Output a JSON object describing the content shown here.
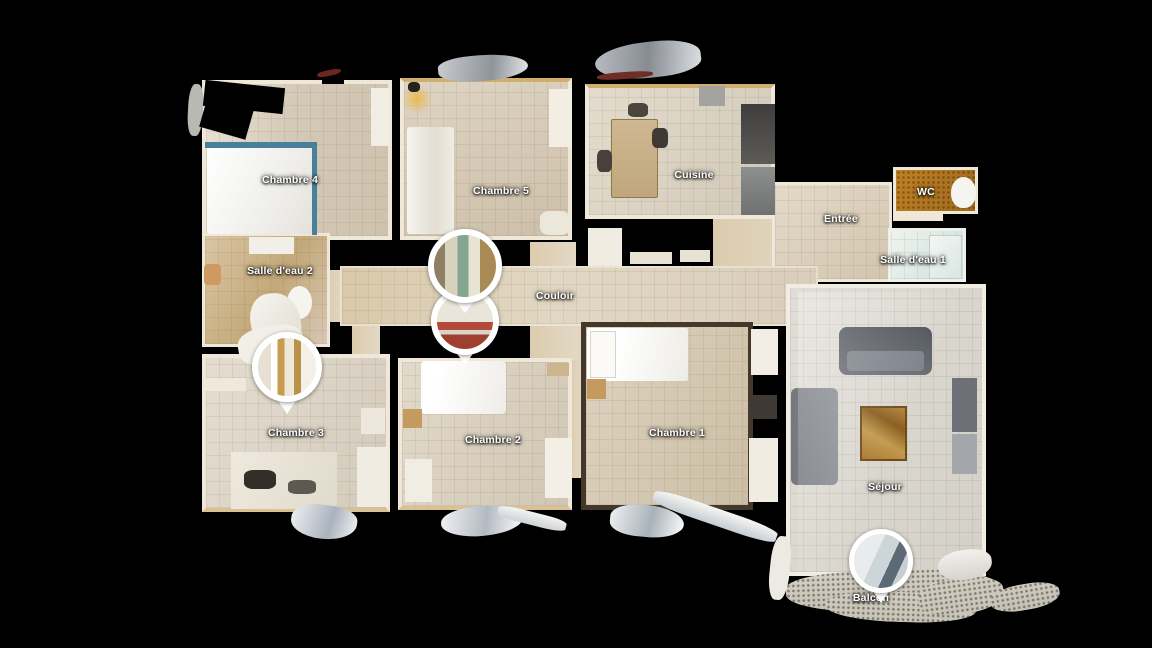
{
  "view": {
    "type": "floorplan-3d-top-view",
    "background": "#000000",
    "label_color": "#ffffff",
    "wall_color": "#efe8d9",
    "marker_ring_color": "#ffffff"
  },
  "floorplan": {
    "rooms": [
      {
        "id": "chambre-4",
        "label": "Chambre 4",
        "x": 202,
        "y": 80,
        "w": 190,
        "h": 160,
        "label_cx": 290,
        "label_cy": 180,
        "floor": "linear-gradient(100deg,#e9e1d3 0%,#d4c9b7 45%,#cfc2ad 100%)",
        "wall": "4px solid #efe8d9"
      },
      {
        "id": "chambre-5",
        "label": "Chambre 5",
        "x": 400,
        "y": 78,
        "w": 172,
        "h": 162,
        "label_cx": 501,
        "label_cy": 191,
        "floor": "linear-gradient(160deg,#ded4c3 0%,#cdbfa9 100%)",
        "wall": "4px solid #efe8d9",
        "wallTop": "#cfae6e"
      },
      {
        "id": "cuisine",
        "label": "Cuisine",
        "x": 585,
        "y": 84,
        "w": 190,
        "h": 135,
        "label_cx": 694,
        "label_cy": 175,
        "floor": "linear-gradient(120deg,#e3dccd 0%,#d1c8b7 100%)",
        "wall": "4px solid #efe8d9",
        "wallTop": "#cfae6e"
      },
      {
        "id": "wc",
        "label": "WC",
        "x": 893,
        "y": 167,
        "w": 85,
        "h": 47,
        "label_cx": 926,
        "label_cy": 192,
        "grid": false,
        "floor": "radial-gradient(rgba(70,40,5,.45) 1px, transparent 1.6px) 0 0/5px 5px, linear-gradient(120deg,#c08124,#9c6a1d)",
        "wall": "3px solid #efe8d9"
      },
      {
        "id": "entree",
        "label": "Entrée",
        "x": 772,
        "y": 182,
        "w": 120,
        "h": 100,
        "label_cx": 841,
        "label_cy": 219,
        "floor": "linear-gradient(140deg,#e4dac9 0%,#d2c5ae 100%)",
        "wall": "3px solid #efe8d9"
      },
      {
        "id": "salle-eau-1",
        "label": "Salle d'eau 1",
        "x": 888,
        "y": 228,
        "w": 78,
        "h": 54,
        "label_cx": 913,
        "label_cy": 260,
        "floor": "linear-gradient(120deg,#eff3f0 0%,#cfe0da 100%)",
        "wall": "3px solid #eef0ea"
      },
      {
        "id": "salle-eau-2",
        "label": "Salle d'eau 2",
        "x": 202,
        "y": 233,
        "w": 128,
        "h": 114,
        "label_cx": 280,
        "label_cy": 271,
        "floor": "linear-gradient(120deg,#dac6a5 0%,#c3a878 55%,#d8c7b4 100%)",
        "wall": "3px solid #efe8d9"
      },
      {
        "id": "couloir",
        "label": "Couloir",
        "x": 340,
        "y": 266,
        "w": 478,
        "h": 60,
        "label_cx": 555,
        "label_cy": 296,
        "floor": "linear-gradient(90deg,#d9c9aa 0%,#e1d7c3 45%,#dacebb 100%)",
        "wall": "2px solid rgba(240,233,219,.7)"
      },
      {
        "id": "chambre-3",
        "label": "Chambre 3",
        "x": 202,
        "y": 354,
        "w": 188,
        "h": 158,
        "label_cx": 296,
        "label_cy": 433,
        "floor": "linear-gradient(115deg,#e4ddd0 0%,#d3cabb 100%)",
        "wall": "4px solid #efe8d9",
        "wallBottom": "#d9c193"
      },
      {
        "id": "chambre-2",
        "label": "Chambre 2",
        "x": 398,
        "y": 358,
        "w": 174,
        "h": 152,
        "label_cx": 493,
        "label_cy": 440,
        "floor": "linear-gradient(115deg,#e1d9ca 0%,#d0c6b3 100%)",
        "wall": "4px solid #efe8d9",
        "wallBottom": "#d9c193"
      },
      {
        "id": "chambre-1",
        "label": "Chambre 1",
        "x": 581,
        "y": 322,
        "w": 172,
        "h": 188,
        "label_cx": 677,
        "label_cy": 433,
        "floor": "linear-gradient(115deg,#ded3c0 0%,#ccbea5 100%)",
        "wall": "5px solid #43382a"
      },
      {
        "id": "sejour",
        "label": "Séjour",
        "x": 786,
        "y": 284,
        "w": 200,
        "h": 292,
        "label_cx": 885,
        "label_cy": 487,
        "floor": "linear-gradient(115deg,#e1ded7 0%,#d3d0c7 100%)",
        "wall": "4px solid #f2ede2"
      },
      {
        "id": "balcon",
        "label": "Balcon",
        "x": 786,
        "y": 570,
        "w": 212,
        "h": 42,
        "label_cx": 871,
        "label_cy": 598,
        "grid": false,
        "rotate": -2,
        "radius": "35% 45% 40% 50%",
        "floor": "radial-gradient(rgba(45,40,30,.5) 1px, transparent 1.6px) 0 0/5px 5px, linear-gradient(#d4cfc3,#c6c1b5)"
      }
    ],
    "passages": [
      {
        "id": "door-couloir-chambre-5",
        "x": 530,
        "y": 242,
        "w": 46,
        "h": 26
      },
      {
        "id": "strip-chambre-2-1",
        "x": 570,
        "y": 326,
        "w": 12,
        "h": 152
      },
      {
        "id": "door-couloir-south",
        "x": 530,
        "y": 326,
        "w": 47,
        "h": 34
      },
      {
        "id": "passage-entree",
        "x": 713,
        "y": 212,
        "w": 100,
        "h": 58
      },
      {
        "id": "door-couloir-chambre-3",
        "x": 352,
        "y": 326,
        "w": 28,
        "h": 30
      },
      {
        "id": "door-salle-eau-2",
        "x": 326,
        "y": 270,
        "w": 18,
        "h": 52
      }
    ],
    "passage_floor": "linear-gradient(90deg,#dcccae,#e2d8c4)",
    "props": [
      {
        "name": "bed-chambre-4",
        "x": 207,
        "y": 146,
        "w": 107,
        "h": 88,
        "fill": "linear-gradient(115deg,#ffffff,#edece8 70%,#e4e1da)",
        "radius": "3px"
      },
      {
        "name": "bed-frame-top-chambre-4",
        "x": 205,
        "y": 142,
        "w": 112,
        "h": 6,
        "fill": "#47809a"
      },
      {
        "name": "bed-frame-right-chambre-4",
        "x": 312,
        "y": 142,
        "w": 5,
        "h": 93,
        "fill": "#47809a"
      },
      {
        "name": "shelf-chambre-4",
        "x": 371,
        "y": 88,
        "w": 19,
        "h": 58,
        "fill": "#f1ede3"
      },
      {
        "name": "wardrobe-chambre-5",
        "x": 407,
        "y": 127,
        "w": 47,
        "h": 107,
        "fill": "linear-gradient(90deg,#f6f4ee,#e2ded2 60%,#efece4)",
        "radius": "3px"
      },
      {
        "name": "lamp-glow-chambre-5",
        "x": 402,
        "y": 84,
        "w": 30,
        "h": 30,
        "fill": "radial-gradient(#e9b94f,rgba(233,185,79,0) 70%)",
        "radius": "50%"
      },
      {
        "name": "lamp-chambre-5",
        "x": 408,
        "y": 82,
        "w": 12,
        "h": 10,
        "fill": "#26221c",
        "radius": "40%"
      },
      {
        "name": "shelf-chambre-5",
        "x": 549,
        "y": 89,
        "w": 23,
        "h": 58,
        "fill": "#f2eee4"
      },
      {
        "name": "cabinet-chambre-5",
        "x": 540,
        "y": 211,
        "w": 30,
        "h": 24,
        "fill": "#ece7db",
        "radius": "30%"
      },
      {
        "name": "kitchen-table",
        "x": 611,
        "y": 119,
        "w": 47,
        "h": 79,
        "fill": "linear-gradient(#cfb892,#bfa67c)",
        "border": "1px solid #8f7848",
        "radius": "2px"
      },
      {
        "name": "kitchen-chair-a",
        "x": 597,
        "y": 150,
        "w": 15,
        "h": 22,
        "fill": "#46413a",
        "radius": "30%"
      },
      {
        "name": "kitchen-chair-b",
        "x": 652,
        "y": 128,
        "w": 16,
        "h": 20,
        "fill": "#3f3a33",
        "radius": "30%"
      },
      {
        "name": "kitchen-chair-c",
        "x": 628,
        "y": 103,
        "w": 20,
        "h": 14,
        "fill": "#4a453d",
        "radius": "30%"
      },
      {
        "name": "kitchen-counter-upper",
        "x": 741,
        "y": 104,
        "w": 34,
        "h": 60,
        "fill": "linear-gradient(#3f3e3c,#5c5b58)"
      },
      {
        "name": "kitchen-counter-lower",
        "x": 741,
        "y": 167,
        "w": 34,
        "h": 48,
        "fill": "linear-gradient(#8e908f,#6f7170)"
      },
      {
        "name": "kitchen-appliance",
        "x": 699,
        "y": 86,
        "w": 26,
        "h": 20,
        "fill": "#a3a3a0"
      },
      {
        "name": "wall-fragment-cuisine-a",
        "x": 588,
        "y": 228,
        "w": 34,
        "h": 38,
        "fill": "#f0ece2"
      },
      {
        "name": "wall-fragment-cuisine-b",
        "x": 630,
        "y": 252,
        "w": 42,
        "h": 12,
        "fill": "#e8e2d4"
      },
      {
        "name": "wall-fragment-cuisine-c",
        "x": 680,
        "y": 250,
        "w": 30,
        "h": 12,
        "fill": "#e8e2d4"
      },
      {
        "name": "toilet-wc",
        "x": 951,
        "y": 177,
        "w": 25,
        "h": 31,
        "fill": "#f6f4ef",
        "radius": "50% 50% 45% 45%"
      },
      {
        "name": "wall-fragment-wc",
        "x": 893,
        "y": 212,
        "w": 50,
        "h": 9,
        "fill": "#efe8d9"
      },
      {
        "name": "shower-salle-eau-1",
        "x": 929,
        "y": 235,
        "w": 33,
        "h": 44,
        "fill": "linear-gradient(135deg,#f3f6f4,#d9e6e1)",
        "border": "1px solid #c2cfc9"
      },
      {
        "name": "sink-salle-eau-2",
        "x": 249,
        "y": 237,
        "w": 45,
        "h": 17,
        "fill": "#f2efe8"
      },
      {
        "name": "toilet-salle-eau-2",
        "x": 287,
        "y": 286,
        "w": 25,
        "h": 33,
        "fill": "#f6f4ef",
        "radius": "50%"
      },
      {
        "name": "stool-salle-eau-2",
        "x": 204,
        "y": 264,
        "w": 17,
        "h": 21,
        "fill": "#cf9a62",
        "radius": "20%"
      },
      {
        "name": "washer-salle-eau-2",
        "x": 251,
        "y": 293,
        "w": 50,
        "h": 62,
        "fill": "linear-gradient(140deg,#f7f5f0,#dfdbd0)",
        "radius": "40% 50% 45% 55%",
        "rotate": -8,
        "z": 8
      },
      {
        "name": "cabinet-top-chambre-3",
        "x": 238,
        "y": 326,
        "w": 66,
        "h": 38,
        "fill": "#f2efe8",
        "radius": "40%",
        "rotate": -10,
        "z": 8
      },
      {
        "name": "desk-chambre-3",
        "x": 231,
        "y": 452,
        "w": 106,
        "h": 57,
        "fill": "linear-gradient(120deg,#efeade,#e0dacc)"
      },
      {
        "name": "desk-chair-chambre-3",
        "x": 244,
        "y": 470,
        "w": 32,
        "h": 19,
        "fill": "#332e27",
        "radius": "30%"
      },
      {
        "name": "desk-item-chambre-3",
        "x": 288,
        "y": 480,
        "w": 28,
        "h": 14,
        "fill": "#5d5850",
        "radius": "30%"
      },
      {
        "name": "shelf-left-chambre-3",
        "x": 204,
        "y": 378,
        "w": 42,
        "h": 13,
        "fill": "#efe9dd"
      },
      {
        "name": "wardrobe-right-chambre-3",
        "x": 357,
        "y": 447,
        "w": 31,
        "h": 60,
        "fill": "#f1ece1"
      },
      {
        "name": "cabinet-right-chambre-3",
        "x": 361,
        "y": 408,
        "w": 24,
        "h": 26,
        "fill": "#eee8dc"
      },
      {
        "name": "bed-chambre-2",
        "x": 421,
        "y": 361,
        "w": 85,
        "h": 53,
        "fill": "linear-gradient(100deg,#ffffff 20%,#efede7)",
        "radius": "4px"
      },
      {
        "name": "nightstand-chambre-2",
        "x": 403,
        "y": 409,
        "w": 19,
        "h": 19,
        "fill": "#c49a5e"
      },
      {
        "name": "cabinet-chambre-2",
        "x": 405,
        "y": 459,
        "w": 27,
        "h": 43,
        "fill": "#f1ede3"
      },
      {
        "name": "wardrobe-chambre-2",
        "x": 545,
        "y": 438,
        "w": 27,
        "h": 60,
        "fill": "#f3efe6"
      },
      {
        "name": "shelf-chambre-2",
        "x": 547,
        "y": 363,
        "w": 22,
        "h": 13,
        "fill": "#cbb48e"
      },
      {
        "name": "bed-chambre-1",
        "x": 587,
        "y": 328,
        "w": 101,
        "h": 53,
        "fill": "linear-gradient(100deg,#ffffff 30%,#eeece6)",
        "radius": "2px"
      },
      {
        "name": "pillow-chambre-1",
        "x": 590,
        "y": 331,
        "w": 26,
        "h": 47,
        "fill": "#fbfaf7",
        "border": "1px solid #d8d4ca"
      },
      {
        "name": "nightstand-chambre-1",
        "x": 587,
        "y": 379,
        "w": 19,
        "h": 20,
        "fill": "#c49a5e"
      },
      {
        "name": "wardrobe-a-chambre-1",
        "x": 751,
        "y": 329,
        "w": 27,
        "h": 46,
        "fill": "#f2eee5"
      },
      {
        "name": "cabinet-dark-chambre-1",
        "x": 749,
        "y": 395,
        "w": 28,
        "h": 24,
        "fill": "#3e3a33"
      },
      {
        "name": "wardrobe-b-chambre-1",
        "x": 749,
        "y": 438,
        "w": 29,
        "h": 64,
        "fill": "#f0ece2"
      },
      {
        "name": "sofa-top-sejour",
        "x": 839,
        "y": 327,
        "w": 93,
        "h": 48,
        "fill": "linear-gradient(#4f535a,#6a6e75)",
        "radius": "8px"
      },
      {
        "name": "sofa-top-seat-sejour",
        "x": 847,
        "y": 351,
        "w": 77,
        "h": 20,
        "fill": "#7e838b",
        "radius": "4px"
      },
      {
        "name": "sofa-left-sejour",
        "x": 791,
        "y": 388,
        "w": 47,
        "h": 97,
        "fill": "linear-gradient(90deg,#74777d,#8d9197)",
        "radius": "6px"
      },
      {
        "name": "coffee-table-sejour",
        "x": 860,
        "y": 406,
        "w": 47,
        "h": 55,
        "fill": "linear-gradient(30deg,#a8762c,#c29a4d 40%,#8a5d20 70%,#b5863a)",
        "border": "2px solid #6f4c1c"
      },
      {
        "name": "bench-right-sejour",
        "x": 952,
        "y": 378,
        "w": 25,
        "h": 54,
        "fill": "#6d7077"
      },
      {
        "name": "bench-right-low-sejour",
        "x": 952,
        "y": 434,
        "w": 25,
        "h": 40,
        "fill": "#a3a6aa"
      },
      {
        "name": "floor-highlight-sejour",
        "x": 798,
        "y": 292,
        "w": 182,
        "h": 280,
        "fill": "linear-gradient(115deg,rgba(255,255,255,.3),rgba(255,255,255,0) 55%)",
        "z": 7
      },
      {
        "name": "ceiling-hole-chambre-4-a",
        "x": 204,
        "y": 84,
        "w": 80,
        "h": 26,
        "rotate": 6,
        "fill": "#000000",
        "z": 7
      },
      {
        "name": "ceiling-hole-chambre-4-b",
        "x": 204,
        "y": 92,
        "w": 48,
        "h": 42,
        "rotate": 16,
        "fill": "#000000",
        "z": 7
      },
      {
        "name": "ceiling-hole-chambre-4-c",
        "x": 322,
        "y": 66,
        "w": 22,
        "h": 18,
        "fill": "#000000",
        "z": 7
      },
      {
        "name": "debris-red-stick",
        "x": 317,
        "y": 70,
        "w": 24,
        "h": 6,
        "rotate": -12,
        "fill": "#6e2420",
        "radius": "40%",
        "z": 8
      },
      {
        "name": "debris-left-chambre-4",
        "x": 188,
        "y": 84,
        "w": 15,
        "h": 52,
        "rotate": 3,
        "fill": "#b9b9b3",
        "radius": "40%"
      },
      {
        "name": "debris-top-chambre-5",
        "x": 438,
        "y": 55,
        "w": 90,
        "h": 26,
        "rotate": -5,
        "fill": "linear-gradient(100deg,#c9ccd0,#8f949a 60%,#e5e7e9)",
        "radius": "40% 60% 50% 50%"
      },
      {
        "name": "debris-top-cuisine",
        "x": 595,
        "y": 42,
        "w": 106,
        "h": 36,
        "rotate": -7,
        "fill": "linear-gradient(100deg,#b9bdc2,#878c93 50%,#dfe1e4)",
        "radius": "50% 50% 40% 60%"
      },
      {
        "name": "debris-red-cuisine",
        "x": 597,
        "y": 72,
        "w": 56,
        "h": 7,
        "rotate": -4,
        "fill": "#6e2d26",
        "radius": "40%"
      },
      {
        "name": "debris-bottom-chambre-3",
        "x": 291,
        "y": 505,
        "w": 66,
        "h": 34,
        "rotate": 8,
        "fill": "linear-gradient(100deg,#eef0f2,#aab2bc 60%,#f4f5f6)",
        "radius": "50% 40% 60% 50%"
      },
      {
        "name": "debris-bottom-chambre-2",
        "x": 441,
        "y": 506,
        "w": 82,
        "h": 30,
        "rotate": -3,
        "fill": "linear-gradient(100deg,#f2f3f4,#b3bac2 55%,#ffffff)",
        "radius": "50% 40% 55% 45%"
      },
      {
        "name": "debris-plank-chambre-2",
        "x": 497,
        "y": 512,
        "w": 70,
        "h": 13,
        "rotate": 14,
        "fill": "linear-gradient(#f4f4f2,#cdd2d6)",
        "radius": "30%"
      },
      {
        "name": "debris-bottom-chambre-1",
        "x": 610,
        "y": 505,
        "w": 74,
        "h": 32,
        "rotate": 5,
        "fill": "linear-gradient(100deg,#f0f1f2,#a9b1ba 55%,#fdfdfd)",
        "radius": "45% 55% 50% 40%"
      },
      {
        "name": "debris-plank-chambre-1",
        "x": 650,
        "y": 508,
        "w": 130,
        "h": 17,
        "rotate": 19,
        "fill": "linear-gradient(#f6f6f4,#c6ccd1)",
        "radius": "30%"
      },
      {
        "name": "debris-left-sejour",
        "x": 770,
        "y": 536,
        "w": 20,
        "h": 64,
        "rotate": 6,
        "fill": "#eceae3",
        "radius": "40%"
      },
      {
        "name": "debris-right-sejour",
        "x": 938,
        "y": 550,
        "w": 54,
        "h": 30,
        "rotate": -6,
        "fill": "linear-gradient(#f2f1ed,#d4d3cd)",
        "radius": "50% 40% 55% 50%"
      },
      {
        "name": "balcon-floor-b",
        "x": 826,
        "y": 592,
        "w": 150,
        "h": 30,
        "rotate": 2,
        "radius": "45%",
        "z": 2,
        "fill": "radial-gradient(rgba(45,40,30,.5) 1px, transparent 1.6px) 0 0/5px 5px, linear-gradient(#d2cdc1,#c8c3b7)"
      },
      {
        "name": "balcon-floor-c",
        "x": 918,
        "y": 578,
        "w": 86,
        "h": 36,
        "rotate": -8,
        "radius": "45%",
        "z": 2,
        "fill": "radial-gradient(rgba(45,40,30,.5) 1px, transparent 1.6px) 0 0/5px 5px, linear-gradient(#d2cdc1,#c8c3b7)"
      },
      {
        "name": "balcon-floor-d",
        "x": 990,
        "y": 584,
        "w": 70,
        "h": 26,
        "rotate": -10,
        "radius": "45%",
        "z": 2,
        "fill": "radial-gradient(rgba(45,40,30,.5) 1px, transparent 1.6px) 0 0/5px 5px, linear-gradient(#cfcabe,#c5c0b4)"
      }
    ],
    "markers": [
      {
        "id": "couloir-lower",
        "room": "Couloir",
        "cx": 465,
        "cy": 321,
        "d": 56,
        "ring": 6,
        "tail": 20,
        "z": 19,
        "photo": "linear-gradient(180deg,#eae5da 0% 52%,#b34a39 52% 66%,#d9d4c8 66% 74%,#a03e30 74% 100%)"
      },
      {
        "id": "couloir-upper",
        "room": "Couloir",
        "cx": 465,
        "cy": 266,
        "d": 62,
        "ring": 6,
        "tail": 20,
        "z": 20,
        "photo": "linear-gradient(90deg,#8f7f63 0% 18%,#d8d1bd 18% 38%,#84a591 38% 56%,#e9e3d3 56% 74%,#a98a55 74% 100%)"
      },
      {
        "id": "chambre-3",
        "room": "Chambre 3",
        "cx": 287,
        "cy": 367,
        "d": 58,
        "ring": 6,
        "tail": 22,
        "z": 18,
        "photo": "linear-gradient(90deg,#e7e0d3 0% 22%,#ffffff 22% 34%,#c79c50 34% 46%,#efe8d9 46% 62%,#bb924c 62% 74%,#f4f0e6 74% 100%)"
      },
      {
        "id": "balcon",
        "room": "Balcon",
        "cx": 881,
        "cy": 561,
        "d": 54,
        "ring": 5,
        "tail": 20,
        "z": 18,
        "photo": "linear-gradient(115deg,#e9ecec 0% 40%,#ccd5d7 40% 62%,#5d6a76 62% 78%,#c8cfd2 78% 100%)"
      }
    ]
  }
}
